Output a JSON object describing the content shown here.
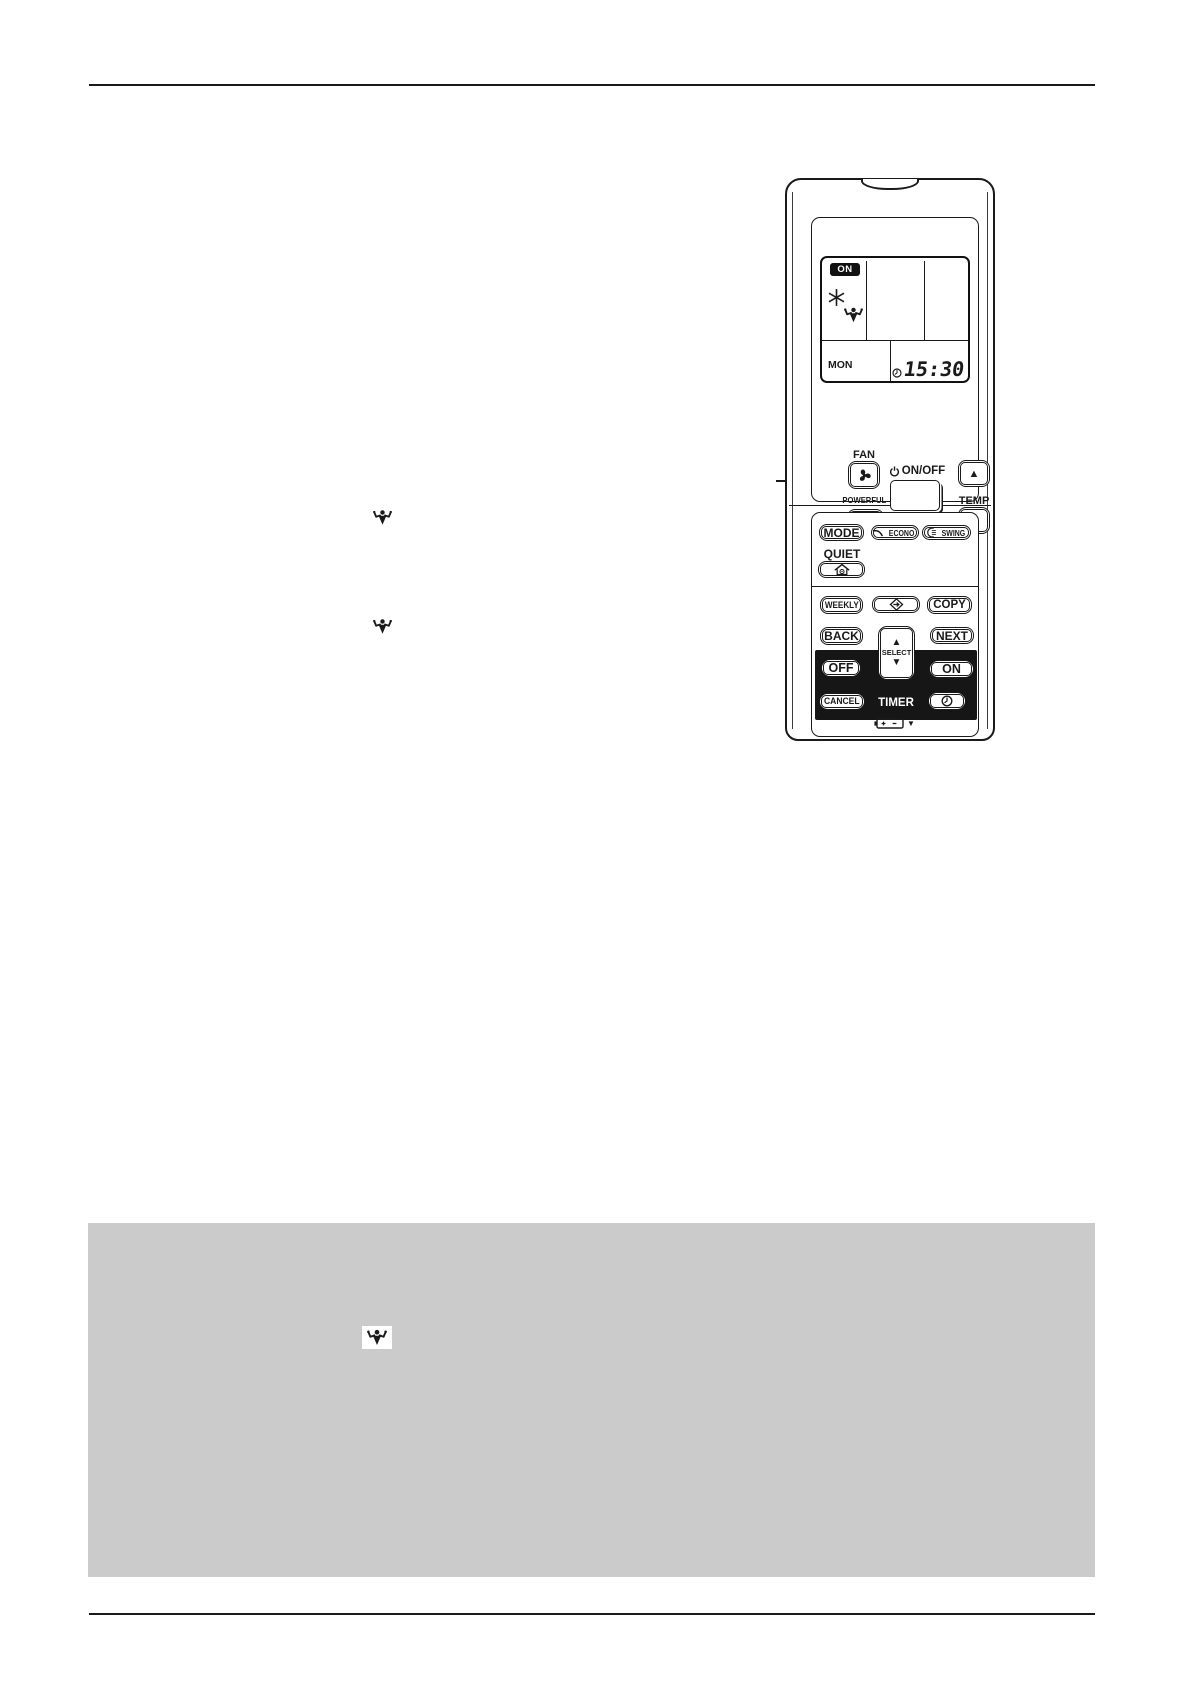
{
  "remote": {
    "brand": "DAIKIN",
    "lcd": {
      "power_badge": "ON",
      "day": "MON",
      "time": "15:30"
    },
    "upper_controls": {
      "fan": "FAN",
      "onoff": "ON/OFF",
      "temp": "TEMP",
      "powerful": "POWERFUL",
      "temp_up_glyph": "▲",
      "temp_down_glyph": "▼"
    },
    "lower_controls": {
      "mode": "MODE",
      "econo": "ECONO",
      "swing": "SWING",
      "quiet": "QUIET",
      "weekly": "WEEKLY",
      "copy": "COPY",
      "back": "BACK",
      "next": "NEXT",
      "select": "SELECT",
      "select_up_glyph": "▲",
      "select_down_glyph": "▼",
      "off": "OFF",
      "on": "ON",
      "cancel": "CANCEL",
      "timer": "TIMER"
    },
    "battery": {
      "plus": "+",
      "minus": "−",
      "pointer_glyph": "▼"
    }
  },
  "icons": {
    "daikin-flag-icon": "brand flag mark",
    "powerful-icon": "flexing muscle figure",
    "snowflake-icon": "cooling snowflake",
    "fan-icon": "fan blades",
    "power-icon": "power standby symbol",
    "clock-icon": "clock face",
    "econo-icon": "econo descending curve",
    "swing-icon": "swing arc with louvers",
    "house-icon": "house with indoor unit (quiet outdoor)",
    "program-arrow-icon": "diamond with arrow",
    "battery-icon": "battery with + and −"
  },
  "colors": {
    "ink": "#1a1a1a",
    "note_box_bg": "#cbcbcb",
    "lcd_badge_bg": "#111111",
    "black_zone_bg": "#161616",
    "page_bg": "#ffffff"
  }
}
